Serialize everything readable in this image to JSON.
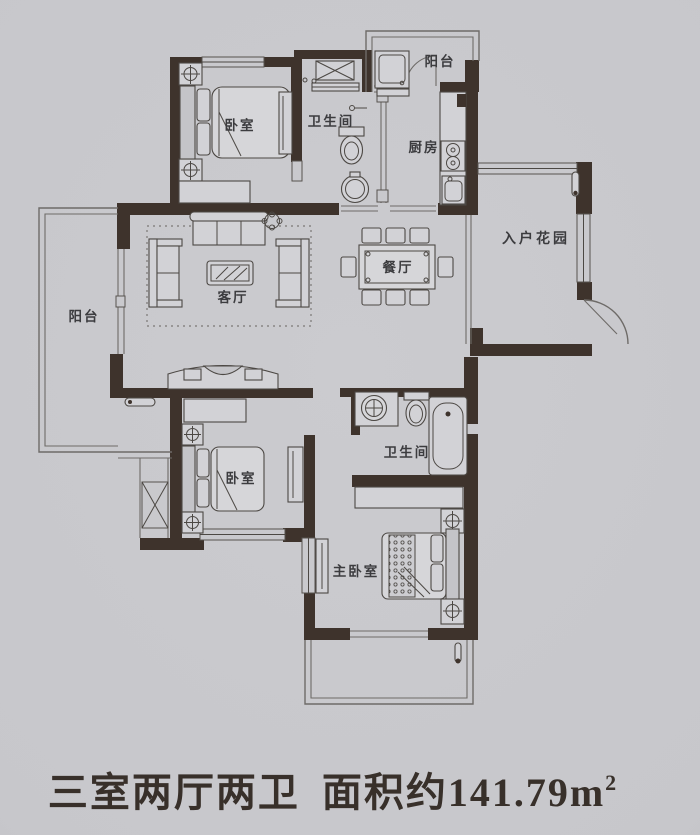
{
  "plan": {
    "rooms": {
      "balcony_top": {
        "label": "阳台"
      },
      "bedroom_top": {
        "label": "卧室"
      },
      "bathroom_top": {
        "label": "卫生间"
      },
      "kitchen": {
        "label": "厨房"
      },
      "entry_garden": {
        "label": "入户花园"
      },
      "dining": {
        "label": "餐厅"
      },
      "living": {
        "label": "客厅"
      },
      "balcony_left": {
        "label": "阳台"
      },
      "bedroom_lower": {
        "label": "卧室"
      },
      "bathroom_lower": {
        "label": "卫生间"
      },
      "master_bedroom": {
        "label": "主卧室"
      }
    },
    "colors": {
      "wall": "#3e332c",
      "background": "#c7c7cb",
      "furniture_line": "#4c4844"
    }
  },
  "caption": {
    "layout_text": "三室两厅两卫",
    "area_prefix": "面积约",
    "area_value": "141.79",
    "area_unit": "m",
    "area_unit_sup": "2"
  }
}
